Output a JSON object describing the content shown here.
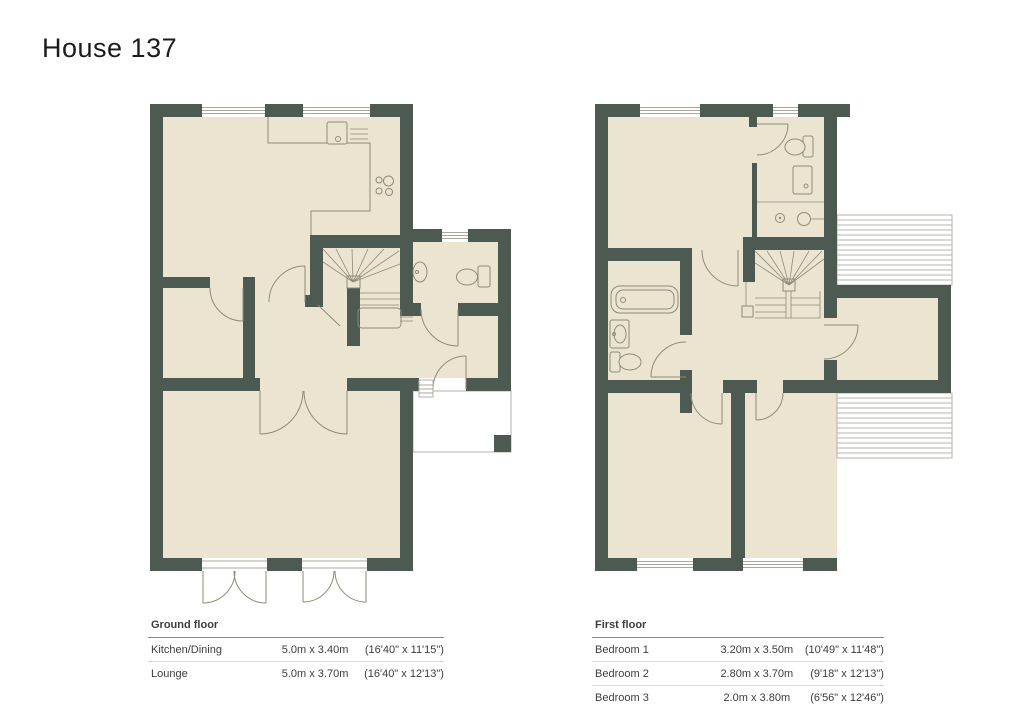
{
  "title": "House 137",
  "colors": {
    "wall": "#4d5a52",
    "floor": "#ebe4d1",
    "fixture_line": "#8f8b77",
    "roof_hatch": "#b6b6ae",
    "text": "#3c3c3c",
    "background": "#ffffff"
  },
  "ground_floor": {
    "label": "Ground floor",
    "rows": [
      {
        "room": "Kitchen/Dining",
        "metric": "5.0m x 3.40m",
        "imperial": "(16'40\" x 11'15\")"
      },
      {
        "room": "Lounge",
        "metric": "5.0m x 3.70m",
        "imperial": "(16'40\" x 12'13\")"
      }
    ]
  },
  "first_floor": {
    "label": "First floor",
    "rows": [
      {
        "room": "Bedroom 1",
        "metric": "3.20m x 3.50m",
        "imperial": "(10'49\" x 11'48\")"
      },
      {
        "room": "Bedroom 2",
        "metric": "2.80m x 3.70m",
        "imperial": "(9'18\" x 12'13\")"
      },
      {
        "room": "Bedroom 3",
        "metric": "2.0m x 3.80m",
        "imperial": "(6'56\" x 12'46\")"
      }
    ]
  }
}
